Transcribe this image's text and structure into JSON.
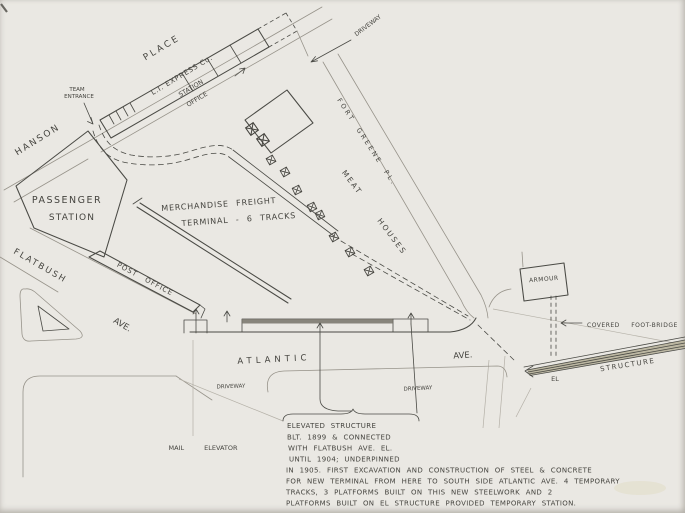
{
  "colors": {
    "paper": "#eae8e3",
    "ink": "#4a4a45",
    "faint_ink": "#97938a",
    "el_band_fill": "#b7b19a"
  },
  "streets": {
    "hanson": "HANSON",
    "place": "PLACE",
    "flatbush": "FLATBUSH",
    "flatbush_ave": "AVE.",
    "atlantic": "ATLANTIC",
    "atlantic_ave": "AVE.",
    "fort_greene_pl": "FORT GREENE PL."
  },
  "buildings": {
    "passenger_line1": "PASSENGER",
    "passenger_line2": "STATION",
    "freight_line1": "MERCHANDISE FREIGHT",
    "freight_line2": "TERMINAL - 6 TRACKS",
    "post_office": "POST OFFICE",
    "li_express": "L.I. EXPRESS Co.",
    "station_office_line1": "STATION",
    "station_office_line2": "OFFICE",
    "armour": "ARMOUR",
    "meat_line1": "MEAT",
    "meat_line2": "HOUSES"
  },
  "labels": {
    "team_line1": "TEAM",
    "team_line2": "ENTRANCE",
    "driveway_top": "DRIVEWAY",
    "driveway_west": "DRIVEWAY",
    "driveway_east": "DRIVEWAY",
    "mail_elevator": "MAIL ELEVATOR",
    "covered_footbridge": "COVERED FOOT-BRIDGE",
    "el": "EL",
    "structure": "STRUCTURE"
  },
  "caption": {
    "lines": [
      "ELEVATED  STRUCTURE",
      "BLT. 1899 & CONNECTED",
      "WITH FLATBUSH AVE. EL.",
      "UNTIL 1904; UNDERPINNED",
      "IN 1905. FIRST EXCAVATION AND CONSTRUCTION OF STEEL & CONCRETE",
      "FOR NEW TERMINAL FROM HERE TO SOUTH SIDE ATLANTIC AVE. 4 TEMPORARY",
      "TRACKS, 3 PLATFORMS BUILT ON THIS NEW STEELWORK AND 2",
      "PLATFORMS BUILT ON EL STRUCTURE PROVIDED TEMPORARY STATION."
    ]
  }
}
